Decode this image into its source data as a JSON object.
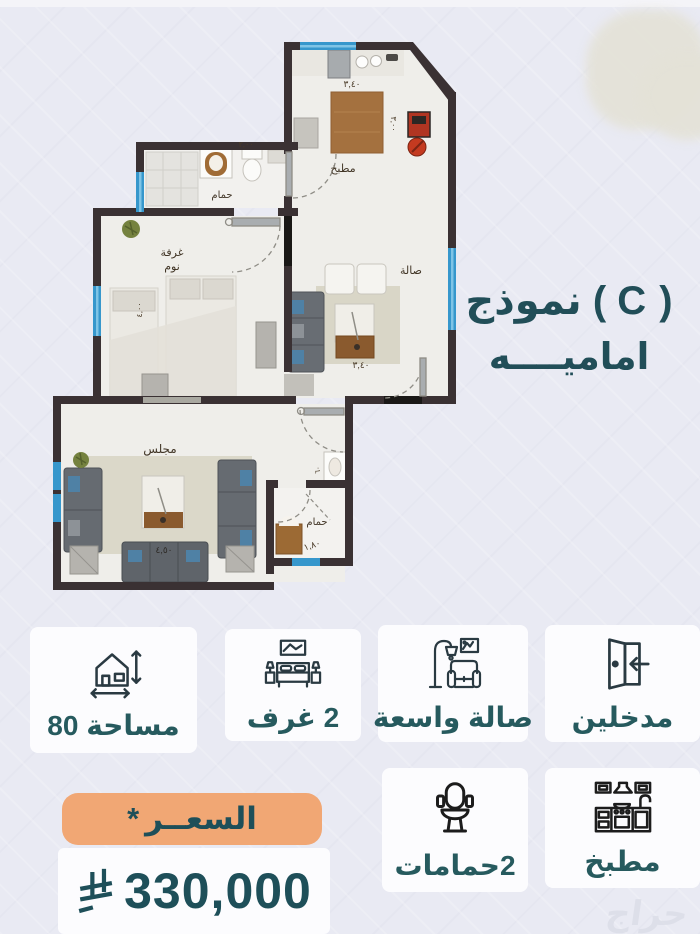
{
  "title": {
    "line1": "نموذج ( C )",
    "line2": "اماميــــه"
  },
  "floorplan": {
    "labels": {
      "kitchen": "مطبخ",
      "hall": "صالة",
      "bath1": "حمام",
      "bedroom1": "غرفة",
      "bedroom2": "نوم",
      "majlis": "مجلس",
      "bath2": "حمام"
    },
    "dims": {
      "kitchen_w": "٣,٤٠",
      "kitchen_h": "٣,٠٠",
      "hall_w": "٣,٤٠",
      "bedroom_h": "٤,٠٠",
      "majlis_w": "٤,٥٠",
      "bath2_w": "١,٨٠",
      "sink_w": "٦٠",
      "bath1_w": "٢,٠٠"
    }
  },
  "features": {
    "area": {
      "label": "مساحة 80"
    },
    "rooms": {
      "label": "2 غرف"
    },
    "hall": {
      "label": "صالة واسعة"
    },
    "entrances": {
      "label": "مدخلين"
    },
    "bathrooms": {
      "label": "2حمامات"
    },
    "kitchen": {
      "label": "مطبخ"
    }
  },
  "price": {
    "label": "السعــر",
    "note_mark": "*",
    "amount": "330,000"
  },
  "watermark": "حراج",
  "colors": {
    "accent_teal": "#235058",
    "pill_orange": "#f1a774",
    "wall": "#3a3133",
    "window_blue": "#3697cc"
  }
}
